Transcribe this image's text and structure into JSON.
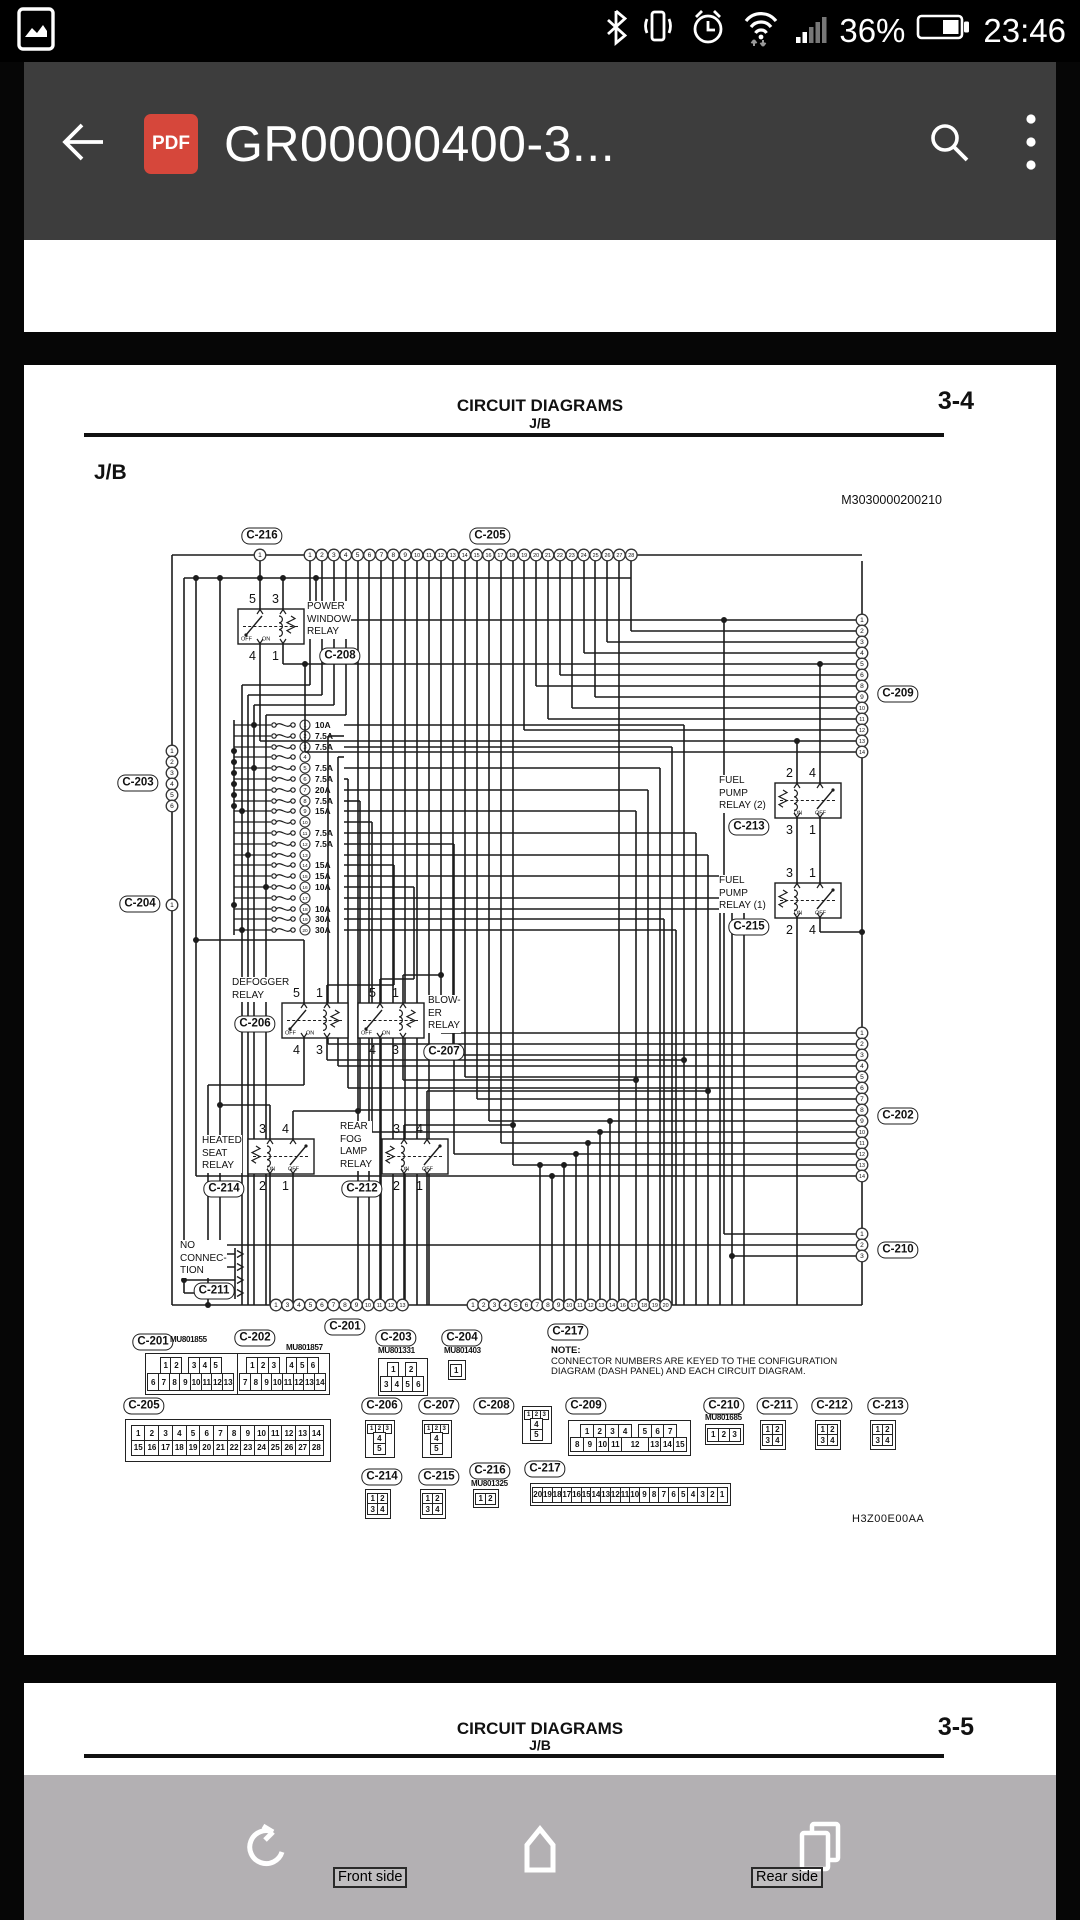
{
  "status_bar": {
    "time": "23:46",
    "battery": "36%"
  },
  "toolbar": {
    "title": "GR00000400-3...",
    "pdf_badge": "PDF"
  },
  "page": {
    "header_title": "CIRCUIT DIAGRAMS",
    "header_sub": "J/B",
    "page_no": "3-4",
    "section": "J/B",
    "doc_code": "M3030000200210",
    "footer_code": "H3Z00E00AA",
    "note": [
      "NOTE:",
      "CONNECTOR NUMBERS ARE KEYED TO THE CONFIGURATION",
      "DIAGRAM (DASH PANEL) AND EACH CIRCUIT DIAGRAM."
    ]
  },
  "diagram": {
    "fuses": [
      "10A",
      "7.5A",
      "7.5A",
      "",
      "7.5A",
      "7.5A",
      "20A",
      "7.5A",
      "15A",
      "",
      "7.5A",
      "7.5A",
      "",
      "15A",
      "15A",
      "10A",
      "",
      "10A",
      "30A",
      "30A"
    ],
    "relays": [
      {
        "name": [
          "POWER",
          "WINDOW",
          "RELAY"
        ],
        "conn": "C-208",
        "pins_top": [
          "5",
          "3"
        ],
        "pins_bottom": [
          "4",
          "1"
        ],
        "sw": [
          "OFF",
          "ON"
        ]
      },
      {
        "name": [
          "FUEL",
          "PUMP",
          "RELAY (2)"
        ],
        "conn": "C-213",
        "pins_top": [
          "2",
          "4"
        ],
        "pins_bottom": [
          "3",
          "1"
        ],
        "sw": [
          "ON",
          "OFF"
        ]
      },
      {
        "name": [
          "FUEL",
          "PUMP",
          "RELAY (1)"
        ],
        "conn": "C-215",
        "pins_top": [
          "3",
          "1"
        ],
        "pins_bottom": [
          "2",
          "4"
        ],
        "sw": [
          "ON",
          "OFF"
        ]
      },
      {
        "name": [
          "DEFOGGER",
          "RELAY"
        ],
        "conn": "C-206",
        "pins_top": [
          "5",
          "1"
        ],
        "pins_bottom": [
          "4",
          "3"
        ],
        "sw": [
          "OFF",
          "ON"
        ]
      },
      {
        "name": [
          "BLOW-",
          "ER",
          "RELAY"
        ],
        "conn": "C-207",
        "pins_top": [
          "5",
          "1"
        ],
        "pins_bottom": [
          "4",
          "3"
        ],
        "sw": [
          "OFF",
          "ON"
        ]
      },
      {
        "name": [
          "HEATED",
          "SEAT",
          "RELAY"
        ],
        "conn": "C-214",
        "pins_top": [
          "3",
          "4"
        ],
        "pins_bottom": [
          "2",
          "1"
        ],
        "sw": [
          "ON",
          "OFF"
        ]
      },
      {
        "name": [
          "REAR",
          "FOG",
          "LAMP",
          "RELAY"
        ],
        "conn": "C-212",
        "pins_top": [
          "3",
          "4"
        ],
        "pins_bottom": [
          "2",
          "1"
        ],
        "sw": [
          "ON",
          "OFF"
        ]
      }
    ],
    "no_connection": {
      "lines": [
        "NO",
        "CONNEC-",
        "TION"
      ],
      "conn": "C-211"
    },
    "pin_groups": {
      "c216": {
        "label": "C-216",
        "pins": [
          "1"
        ]
      },
      "c205": {
        "label": "C-205",
        "pins": [
          "1",
          "2",
          "3",
          "4",
          "5",
          "6",
          "7",
          "8",
          "9",
          "10",
          "11",
          "12",
          "13",
          "14",
          "15",
          "16",
          "17",
          "18",
          "19",
          "20",
          "21",
          "22",
          "23",
          "24",
          "25",
          "26",
          "27",
          "28"
        ]
      },
      "c209": {
        "label": "C-209",
        "pins": [
          "1",
          "2",
          "3",
          "4",
          "5",
          "6",
          "8",
          "9",
          "10",
          "11",
          "12",
          "13",
          "14"
        ]
      },
      "c202": {
        "label": "C-202",
        "pins": [
          "1",
          "2",
          "3",
          "4",
          "5",
          "6",
          "7",
          "8",
          "9",
          "10",
          "11",
          "12",
          "13",
          "14"
        ]
      },
      "c210": {
        "label": "C-210",
        "pins": [
          "1",
          "2",
          "3"
        ]
      },
      "c203": {
        "label": "C-203",
        "pins": [
          "1",
          "2",
          "3",
          "4",
          "5",
          "6"
        ]
      },
      "c204": {
        "label": "C-204",
        "pins": [
          "1"
        ]
      },
      "c201b": {
        "label": "C-201",
        "pins": [
          "1",
          "3",
          "4",
          "5",
          "6",
          "7",
          "8",
          "9",
          "10",
          "11",
          "12",
          "13"
        ]
      },
      "c217b": {
        "label": "C-217",
        "pins": [
          "1",
          "2",
          "3",
          "4",
          "5",
          "6",
          "7",
          "8",
          "9",
          "10",
          "11",
          "12",
          "13",
          "14",
          "16",
          "17",
          "18",
          "19",
          "20"
        ]
      }
    }
  },
  "pinouts": [
    {
      "id": "C-201",
      "part": "MU801855",
      "rows": [
        [
          "1",
          "2",
          "",
          "3",
          "4",
          "5"
        ],
        [
          "6",
          "7",
          "8",
          "9",
          "10",
          "11",
          "12",
          "13"
        ]
      ]
    },
    {
      "id": "C-202",
      "part": "MU801857",
      "rows": [
        [
          "1",
          "2",
          "3",
          "",
          "4",
          "5",
          "6"
        ],
        [
          "7",
          "8",
          "9",
          "10",
          "11",
          "12",
          "13",
          "14"
        ]
      ]
    },
    {
      "id": "C-203",
      "part": "MU801331",
      "rows": [
        [
          "1",
          "",
          "2"
        ],
        [
          "3",
          "4",
          "5",
          "6"
        ]
      ]
    },
    {
      "id": "C-204",
      "part": "MU801403",
      "rows": [
        [
          "1"
        ]
      ]
    },
    {
      "id": "C-205",
      "rows": [
        [
          "1",
          "2",
          "3",
          "4",
          "5",
          "6",
          "7",
          "8",
          "9",
          "10",
          "11",
          "12",
          "13",
          "14"
        ],
        [
          "15",
          "16",
          "17",
          "18",
          "19",
          "20",
          "21",
          "22",
          "23",
          "24",
          "25",
          "26",
          "27",
          "28"
        ]
      ]
    },
    {
      "id": "C-206",
      "rows": [
        [
          "1",
          "2",
          "3"
        ],
        [
          "4"
        ],
        [
          "5"
        ]
      ]
    },
    {
      "id": "C-207",
      "rows": [
        [
          "1",
          "2",
          "3"
        ],
        [
          "4"
        ],
        [
          "5"
        ]
      ]
    },
    {
      "id": "C-208",
      "rows": [
        [
          "1",
          "2",
          "3"
        ],
        [
          "4"
        ],
        [
          "5"
        ]
      ]
    },
    {
      "id": "C-209",
      "rows": [
        [
          "1",
          "2",
          "3",
          "4",
          "",
          "5",
          "6",
          "7"
        ],
        [
          "8",
          "9",
          "10",
          "11",
          {
            "t": "12",
            "w": 2
          },
          "13",
          "14",
          "15"
        ]
      ]
    },
    {
      "id": "C-210",
      "part": "MU801685",
      "rows": [
        [
          "1",
          "2",
          "3"
        ]
      ]
    },
    {
      "id": "C-211",
      "rows": [
        [
          "1",
          "2"
        ],
        [
          "3",
          "4"
        ]
      ]
    },
    {
      "id": "C-212",
      "rows": [
        [
          "1",
          "2"
        ],
        [
          "3",
          "4"
        ]
      ]
    },
    {
      "id": "C-213",
      "rows": [
        [
          "1",
          "2"
        ],
        [
          "3",
          "4"
        ]
      ]
    },
    {
      "id": "C-214",
      "rows": [
        [
          "1",
          "2"
        ],
        [
          "3",
          "4"
        ]
      ]
    },
    {
      "id": "C-215",
      "rows": [
        [
          "1",
          "2"
        ],
        [
          "3",
          "4"
        ]
      ]
    },
    {
      "id": "C-216",
      "part": "MU801325",
      "rows": [
        [
          "1",
          "2"
        ]
      ]
    },
    {
      "id": "C-217",
      "rows": [
        [
          "20",
          "19",
          "18",
          "17",
          "16",
          "15",
          "14",
          "13",
          "12",
          "11",
          "10",
          "9",
          "8",
          "7",
          "6",
          "5",
          "4",
          "3",
          "2",
          "1"
        ]
      ]
    }
  ],
  "page2": {
    "header_title": "CIRCUIT DIAGRAMS",
    "header_sub": "J/B",
    "page_no": "3-5"
  },
  "nav": {
    "front": "Front side",
    "rear": "Rear side"
  }
}
